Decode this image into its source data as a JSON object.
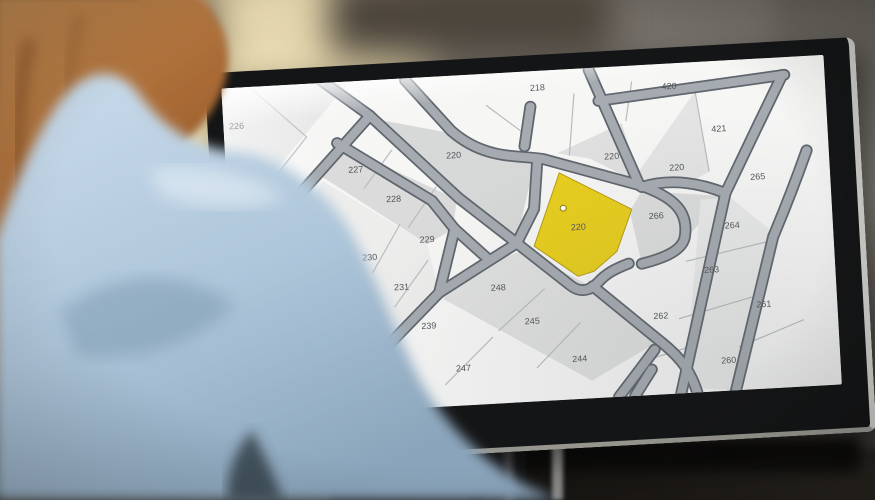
{
  "scene": {
    "description_hint": "person-at-desk-viewing-cadastral-map"
  },
  "monitor": {
    "screen": {
      "map": {
        "type": "cadastral-parcel-map",
        "highlighted_parcel": {
          "id": "220",
          "fill": "#e8ce1d",
          "edge": "#b49c10",
          "marker": {
            "x": 333,
            "y": 141
          }
        },
        "labels": [
          {
            "id": "226",
            "x": 13,
            "y": 42
          },
          {
            "id": "218",
            "x": 314,
            "y": 20
          },
          {
            "id": "420",
            "x": 445,
            "y": 26
          },
          {
            "id": "421",
            "x": 492,
            "y": 72
          },
          {
            "id": "265",
            "x": 528,
            "y": 123
          },
          {
            "id": "227",
            "x": 129,
            "y": 93
          },
          {
            "id": "220",
            "x": 227,
            "y": 84
          },
          {
            "id": "228",
            "x": 165,
            "y": 125
          },
          {
            "id": "220",
            "x": 384,
            "y": 94
          },
          {
            "id": "220",
            "x": 448,
            "y": 109
          },
          {
            "id": "266",
            "x": 425,
            "y": 157
          },
          {
            "id": "264",
            "x": 500,
            "y": 171
          },
          {
            "id": "229",
            "x": 196,
            "y": 168
          },
          {
            "id": "230",
            "x": 138,
            "y": 183
          },
          {
            "id": "263",
            "x": 477,
            "y": 215
          },
          {
            "id": "231",
            "x": 168,
            "y": 215
          },
          {
            "id": "220",
            "x": 347,
            "y": 164,
            "highlight": true
          },
          {
            "id": "248",
            "x": 264,
            "y": 221
          },
          {
            "id": "262",
            "x": 424,
            "y": 259
          },
          {
            "id": "261",
            "x": 527,
            "y": 253
          },
          {
            "id": "239",
            "x": 193,
            "y": 256
          },
          {
            "id": "245",
            "x": 296,
            "y": 257
          },
          {
            "id": "247",
            "x": 225,
            "y": 301
          },
          {
            "id": "244",
            "x": 341,
            "y": 298
          },
          {
            "id": "260",
            "x": 489,
            "y": 308
          }
        ]
      }
    }
  },
  "palette": {
    "road_fill": "#a5abb0",
    "road_edge": "#5f666d",
    "parcel_line": "#b9bcbe",
    "map_background": "#f6f6f5",
    "label_color": "#54585c",
    "bezel": "#141516",
    "shirt_blue": "#c2d6e8",
    "hair_copper": "#ab6c38",
    "wall_warm": "#dccda3",
    "wall_gray": "#8d8882"
  }
}
